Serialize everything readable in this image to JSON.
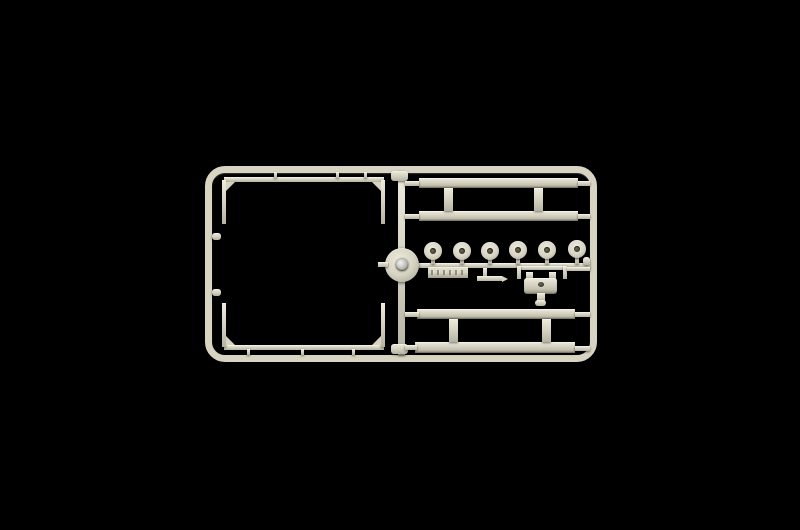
{
  "scene": {
    "description": "Photograph of a light beige injection-molded plastic model-kit sprue (parts runner) centered on a solid black background",
    "background_color": "#000000",
    "plastic_color": "#d8d4c3",
    "plastic_highlight": "#eeebdd",
    "plastic_shadow": "#96927f",
    "plastic_midshadow": "#b7b3a2",
    "metal_pin_color": "#c9c9c4"
  },
  "sprue": {
    "frame_label": "outer rectangular runner frame with rounded corners",
    "center_runner_label": "central vertical runner",
    "hub_label": "round runner boss with metal pin at sprue center",
    "square_part_label": "large square frame part with corner gussets (left half)",
    "top_rails_label": "two long flat chassis-rail parts (upper right)",
    "bottom_rails_label": "two long flat chassis-rail parts (lower right)",
    "wheel_row_label": "row of six round wheel-hub parts on a horizontal runner",
    "wheel_count": 6,
    "tag_label": "molded part-number tag (embossed, illegible)",
    "t_part_label": "small T-shaped part with pointed end",
    "coupling_label": "small coupling part with ears, center hole and stem"
  }
}
